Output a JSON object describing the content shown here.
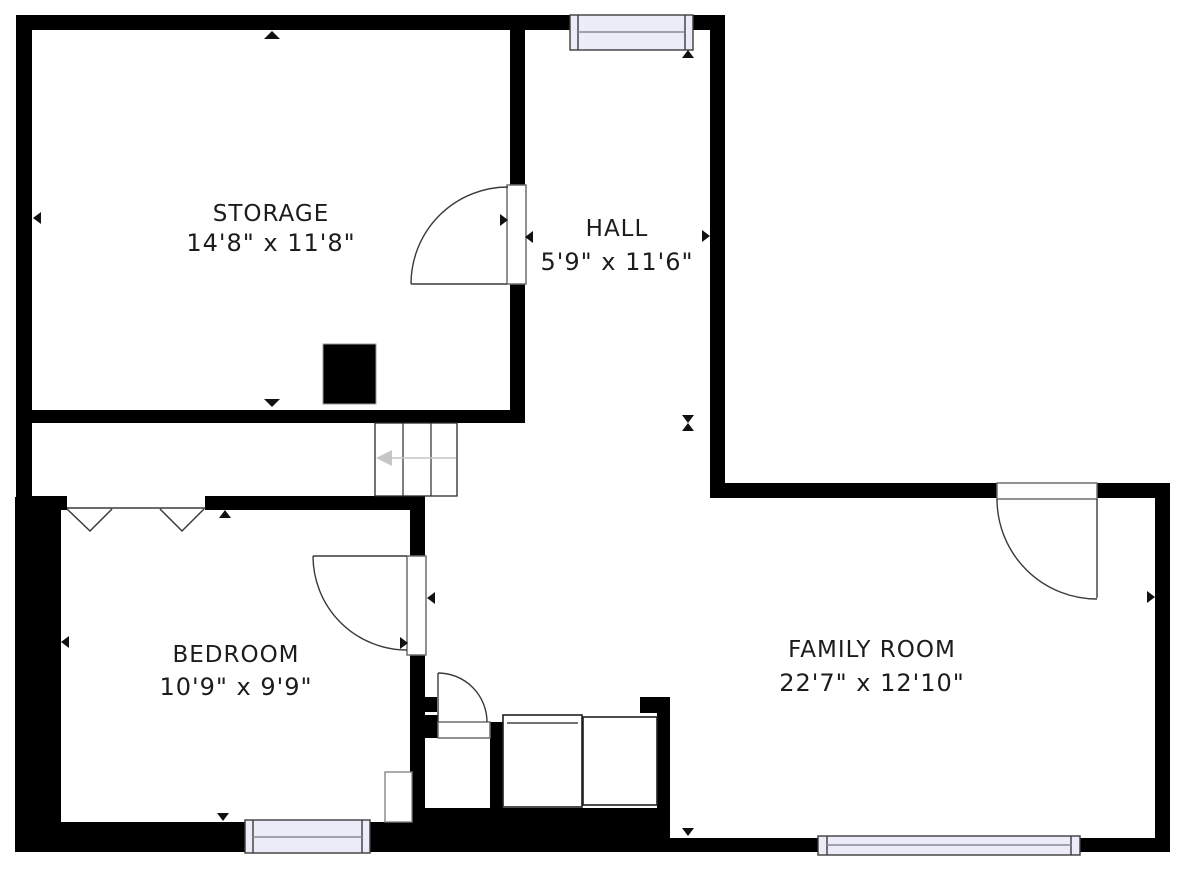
{
  "plan": {
    "type": "floor-plan",
    "colors": {
      "paper": "#ffffff",
      "wall": "#000000",
      "window_glass": "#ebecf7",
      "window_frame": "#3c3c3c",
      "door_line": "#3a3a3a",
      "door_frame": "#6e6e6e",
      "stair_line": "#2a2a2a",
      "stair_arrow": "#c6c6c6",
      "fixture_line": "#1f1f1f",
      "marker": "#111111",
      "text": "#1c1c1c"
    },
    "rooms": [
      {
        "id": "storage",
        "name": "STORAGE",
        "dimensions": "14'8\" x 11'8\""
      },
      {
        "id": "hall",
        "name": "HALL",
        "dimensions": "5'9\" x 11'6\""
      },
      {
        "id": "bedroom",
        "name": "BEDROOM",
        "dimensions": "10'9\" x 9'9\""
      },
      {
        "id": "family_room",
        "name": "FAMILY ROOM",
        "dimensions": "22'7\" x 12'10\""
      }
    ]
  }
}
